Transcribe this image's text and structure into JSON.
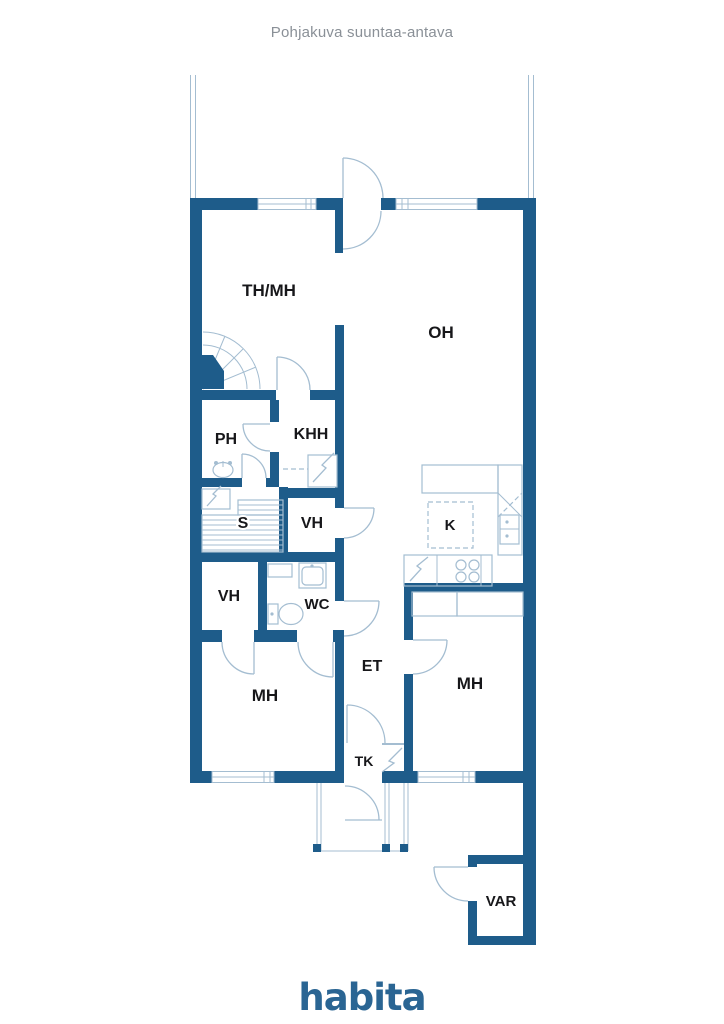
{
  "title": "Pohjakuva suuntaa-antava",
  "logo": "habita",
  "colors": {
    "wall": "#1e5c8a",
    "thin_line": "#a4bdd1",
    "label_text": "#17171a",
    "title_text": "#8a9097",
    "logo_blue": "#2a6593"
  },
  "rooms": {
    "th_mh": {
      "label": "TH/MH"
    },
    "oh": {
      "label": "OH"
    },
    "ph": {
      "label": "PH"
    },
    "khh": {
      "label": "KHH"
    },
    "s": {
      "label": "S"
    },
    "vh_upper": {
      "label": "VH"
    },
    "k": {
      "label": "K"
    },
    "vh_lower": {
      "label": "VH"
    },
    "wc": {
      "label": "WC"
    },
    "et": {
      "label": "ET"
    },
    "mh_left": {
      "label": "MH"
    },
    "mh_right": {
      "label": "MH"
    },
    "tk": {
      "label": "TK"
    },
    "var": {
      "label": "VAR"
    }
  }
}
